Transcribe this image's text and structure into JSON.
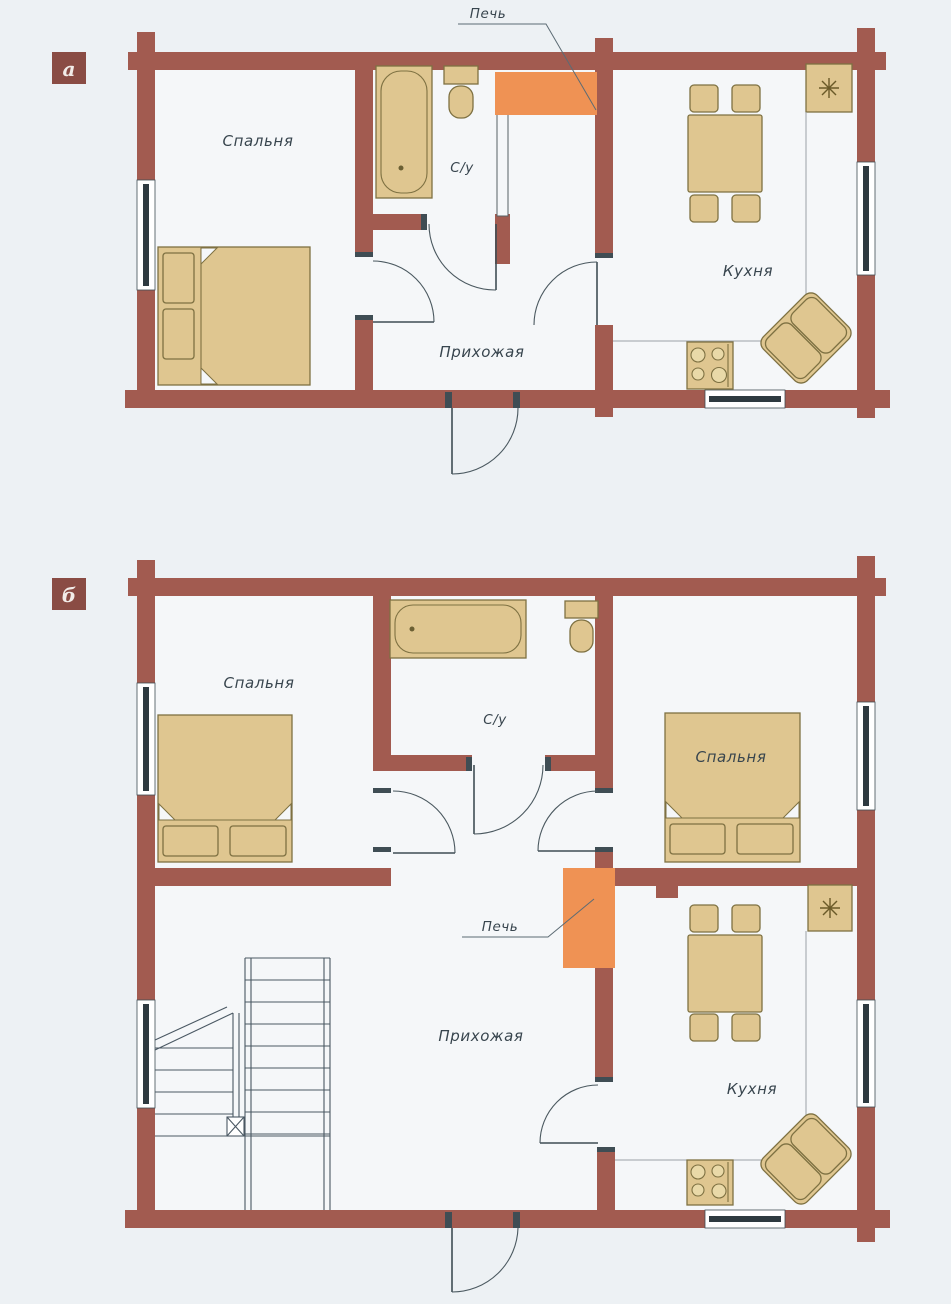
{
  "figure": {
    "description_type": "floor-plans",
    "colors": {
      "background": "#edf1f4",
      "wall": "#a25b50",
      "furniture": "#dfc690",
      "furniture_outline": "#7e7142",
      "masonry_stove": "#ef9254",
      "marker_box": "#8a4c44",
      "label_text": "#38454e"
    }
  },
  "plan_a": {
    "marker": "а",
    "labels": {
      "bedroom": "Спальня",
      "bathroom": "С/у",
      "kitchen": "Кухня",
      "hallway": "Прихожая"
    },
    "callout": {
      "stove": "Печь"
    }
  },
  "plan_b": {
    "marker": "б",
    "labels": {
      "bedroom_left": "Спальня",
      "bedroom_right": "Спальня",
      "bathroom": "С/у",
      "kitchen": "Кухня",
      "hallway": "Прихожая"
    },
    "callout": {
      "stove": "Печь"
    }
  }
}
